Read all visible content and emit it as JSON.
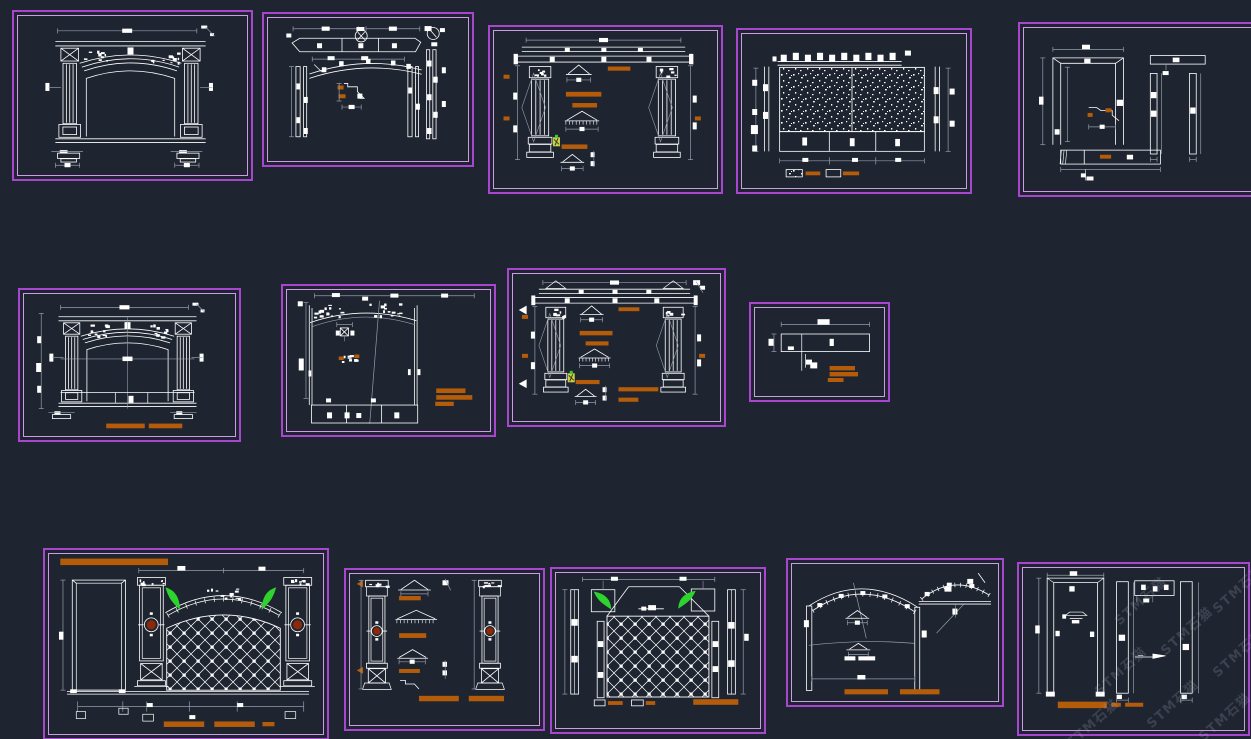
{
  "canvas": {
    "width": 1251,
    "height": 739,
    "background": "#1e2430"
  },
  "colors": {
    "frame_outer": "#a946cf",
    "frame_inner": "#cf9ae6",
    "line": "#ffffff",
    "dim": "#959dab",
    "annotation_orange": "#b45c0a",
    "ornament_green": "#2ed32e",
    "medallion_red": "#8c2a08",
    "icon_yellow": "#c9d14a",
    "watermark": "rgba(176,186,202,0.20)"
  },
  "watermark": {
    "text": "STM石猫",
    "rotation_deg": -42,
    "instances": [
      {
        "x": 1238,
        "y": 588
      },
      {
        "x": 1186,
        "y": 630
      },
      {
        "x": 1120,
        "y": 670
      },
      {
        "x": 1172,
        "y": 703
      },
      {
        "x": 1092,
        "y": 722
      },
      {
        "x": 1238,
        "y": 652
      },
      {
        "x": 1224,
        "y": 716
      },
      {
        "x": 1140,
        "y": 600
      }
    ]
  },
  "panels": [
    {
      "id": "a",
      "name": "arch-portal-elevation",
      "type": "arch_elevation",
      "variant": "A",
      "x": 12,
      "y": 10,
      "w": 237,
      "h": 167,
      "features": [
        "fluted columns",
        "x-box capitals",
        "triple arch moulding",
        "base detail callouts"
      ]
    },
    {
      "id": "b",
      "name": "arch-frame-construction",
      "type": "arch_construction",
      "x": 262,
      "y": 12,
      "w": 208,
      "h": 151,
      "features": [
        "segmented top band",
        "circled section symbols",
        "double arch curve",
        "side post sections",
        "orange detail marks"
      ]
    },
    {
      "id": "c",
      "name": "column-assembly-details",
      "type": "column_details",
      "variant": "C",
      "x": 488,
      "y": 25,
      "w": 231,
      "h": 165,
      "features": [
        "entablature",
        "two fluted columns",
        "moulding profiles",
        "orange label bars",
        "plant symbol"
      ]
    },
    {
      "id": "d",
      "name": "stone-cladding-panel",
      "type": "stone_panel",
      "x": 736,
      "y": 28,
      "w": 232,
      "h": 162,
      "features": [
        "speckled stone texture",
        "two panes",
        "bottom plinth row",
        "material legend"
      ]
    },
    {
      "id": "e",
      "name": "door-frame-members",
      "type": "door_frames",
      "x": 1018,
      "y": 22,
      "w": 240,
      "h": 171,
      "features": [
        "door frame elevation",
        "jamb sections",
        "bottom sill member",
        "clipped at right edge"
      ]
    },
    {
      "id": "f",
      "name": "arch-portal-elevation-dimensioned",
      "type": "arch_elevation",
      "variant": "F",
      "x": 18,
      "y": 288,
      "w": 219,
      "h": 150,
      "features": [
        "centerlines",
        "left dimension chain",
        "bottom panel band",
        "two orange label bars"
      ]
    },
    {
      "id": "g",
      "name": "arch-panel-elevation",
      "type": "arch_panel",
      "x": 281,
      "y": 284,
      "w": 211,
      "h": 149,
      "features": [
        "ornamented arch head",
        "center cartouche",
        "diagonal leader",
        "three orange label bars",
        "bottom plinth row"
      ]
    },
    {
      "id": "h",
      "name": "fireplace-column-details",
      "type": "column_details",
      "variant": "H",
      "x": 507,
      "y": 268,
      "w": 215,
      "h": 155,
      "features": [
        "pediment ends",
        "two fluted columns",
        "moulding profiles",
        "orange label bars",
        "section arrows"
      ]
    },
    {
      "id": "i",
      "name": "beam-detail",
      "type": "small_beam",
      "x": 749,
      "y": 302,
      "w": 137,
      "h": 96,
      "features": [
        "horizontal member",
        "leader line",
        "three orange label bars"
      ]
    },
    {
      "id": "j",
      "name": "feature-wall-elevation",
      "type": "grand_elevation",
      "x": 43,
      "y": 548,
      "w": 282,
      "h": 188,
      "features": [
        "orange title bar",
        "door leaf",
        "pilasters with red medallions",
        "green spandrel ornaments",
        "lattice arch panel",
        "orange label bars"
      ]
    },
    {
      "id": "k",
      "name": "pilaster-pair-details",
      "type": "column_pair_details",
      "x": 344,
      "y": 568,
      "w": 197,
      "h": 159,
      "features": [
        "two pilasters with red medallions",
        "moulding profile stack",
        "orange label bars",
        "side arrow markers"
      ]
    },
    {
      "id": "l",
      "name": "lattice-wall-panel",
      "type": "lattice_panel",
      "x": 550,
      "y": 567,
      "w": 212,
      "h": 163,
      "features": [
        "hood with green ornaments",
        "diamond lattice field",
        "side jamb strips",
        "material legend",
        "orange label bar"
      ]
    },
    {
      "id": "m",
      "name": "arch-segment-details",
      "type": "arch_details",
      "x": 786,
      "y": 558,
      "w": 214,
      "h": 145,
      "features": [
        "ticked arch with posts",
        "secondary arc detail",
        "radial leaders",
        "white label text",
        "two orange label bars"
      ]
    },
    {
      "id": "n",
      "name": "door-jamb-elevation",
      "type": "door_elevation",
      "x": 1017,
      "y": 562,
      "w": 229,
      "h": 170,
      "features": [
        "door frame",
        "jamb bars",
        "head box detail",
        "section arrow",
        "orange label bar",
        "watermark overlay"
      ]
    }
  ]
}
